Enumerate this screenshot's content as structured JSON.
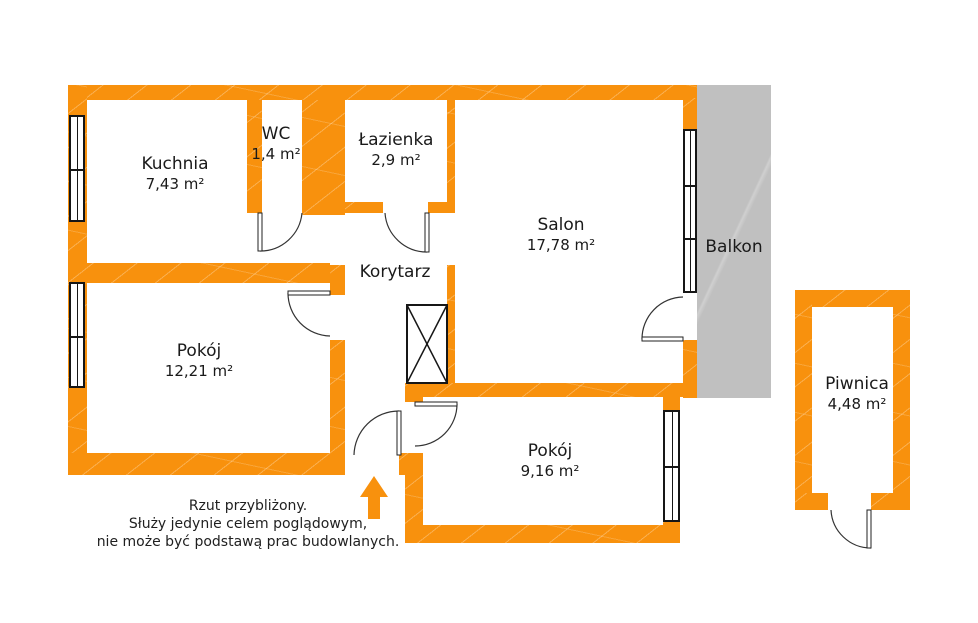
{
  "title": "Rzut mieszkania",
  "colors": {
    "wall": "#f8910d",
    "balcony": "#c0c0c0",
    "text": "#1a1a1a"
  },
  "rooms": [
    {
      "id": "kuchnia",
      "name": "Kuchnia",
      "area": "7,43 m²",
      "cx": 175,
      "cy": 174
    },
    {
      "id": "wc",
      "name": "WC",
      "area": "1,4 m²",
      "cx": 276,
      "cy": 144
    },
    {
      "id": "lazienka",
      "name": "Łazienka",
      "area": "2,9 m²",
      "cx": 396,
      "cy": 150
    },
    {
      "id": "salon",
      "name": "Salon",
      "area": "17,78 m²",
      "cx": 561,
      "cy": 235
    },
    {
      "id": "pokoj-1",
      "name": "Pokój",
      "area": "12,21 m²",
      "cx": 199,
      "cy": 361
    },
    {
      "id": "pokoj-2",
      "name": "Pokój",
      "area": "9,16 m²",
      "cx": 550,
      "cy": 461
    },
    {
      "id": "piwnica",
      "name": "Piwnica",
      "area": "4,48 m²",
      "cx": 857,
      "cy": 394
    }
  ],
  "korytarz_label": {
    "text": "Korytarz"
  },
  "balkon": {
    "label": "Balkon"
  },
  "disclaimer": {
    "lines": [
      "Rzut przybliżony.",
      "Służy jedynie celem poglądowym,",
      "nie może być podstawą prac budowlanych."
    ]
  },
  "geometry": {
    "walls": [
      {
        "name": "outer-top",
        "rect": [
          68,
          85,
          629,
          15
        ]
      },
      {
        "name": "outer-left",
        "rect": [
          68,
          85,
          19,
          390
        ]
      },
      {
        "name": "kitchen-wc-wall",
        "rect": [
          247,
          100,
          15,
          113
        ]
      },
      {
        "name": "wc-bath-block",
        "rect": [
          302,
          100,
          43,
          115
        ]
      },
      {
        "name": "bath-bottom-left",
        "rect": [
          345,
          202,
          38,
          11
        ]
      },
      {
        "name": "bath-bottom-right",
        "rect": [
          428,
          202,
          27,
          11
        ]
      },
      {
        "name": "salon-left-upper",
        "rect": [
          447,
          100,
          8,
          110
        ]
      },
      {
        "name": "salon-left-lower",
        "rect": [
          447,
          265,
          8,
          132
        ]
      },
      {
        "name": "salon-bottom",
        "rect": [
          405,
          383,
          292,
          14
        ]
      },
      {
        "name": "salon-right-upper",
        "rect": [
          683,
          98,
          14,
          32
        ]
      },
      {
        "name": "salon-right-lower",
        "rect": [
          683,
          340,
          14,
          58
        ]
      },
      {
        "name": "kitchen-bottom",
        "rect": [
          68,
          263,
          262,
          20
        ]
      },
      {
        "name": "pokoj1-right-stub",
        "rect": [
          330,
          265,
          15,
          30
        ]
      },
      {
        "name": "pokoj1-right",
        "rect": [
          330,
          340,
          15,
          135
        ]
      },
      {
        "name": "outer-bottom-left",
        "rect": [
          68,
          453,
          277,
          22
        ]
      },
      {
        "name": "entrance-jamb",
        "rect": [
          399,
          453,
          24,
          22
        ]
      },
      {
        "name": "pokoj2-door-stub",
        "rect": [
          405,
          397,
          18,
          5
        ]
      },
      {
        "name": "pokoj2-left",
        "rect": [
          405,
          475,
          18,
          68
        ]
      },
      {
        "name": "pokoj2-bottom",
        "rect": [
          405,
          525,
          275,
          18
        ]
      },
      {
        "name": "pokoj2-right-upper",
        "rect": [
          663,
          397,
          17,
          13
        ]
      },
      {
        "name": "pokoj2-right-lower",
        "rect": [
          663,
          522,
          17,
          21
        ]
      },
      {
        "name": "piwnica-top",
        "rect": [
          795,
          290,
          115,
          17
        ]
      },
      {
        "name": "piwnica-left",
        "rect": [
          795,
          290,
          17,
          220
        ]
      },
      {
        "name": "piwnica-right",
        "rect": [
          893,
          290,
          17,
          220
        ]
      },
      {
        "name": "piwnica-bottom-left",
        "rect": [
          795,
          493,
          33,
          17
        ]
      },
      {
        "name": "piwnica-bottom-right",
        "rect": [
          871,
          493,
          39,
          17
        ]
      }
    ],
    "windows": [
      {
        "name": "kitchen-window",
        "rect": [
          69,
          115,
          16,
          107
        ],
        "dividers": [
          169
        ]
      },
      {
        "name": "pokoj1-window",
        "rect": [
          69,
          282,
          16,
          106
        ],
        "dividers": [
          336
        ]
      },
      {
        "name": "salon-window",
        "rect": [
          683,
          129,
          14,
          164
        ],
        "dividers": [
          185,
          238
        ]
      },
      {
        "name": "pokoj2-window",
        "rect": [
          663,
          410,
          17,
          112
        ],
        "dividers": [
          466
        ]
      }
    ],
    "doors": [
      {
        "name": "wc-door",
        "leaf": [
          258,
          213,
          4,
          38
        ],
        "arc": "M 302 213 A 42 42 0 0 1 260 251"
      },
      {
        "name": "bathroom-door",
        "leaf": [
          425,
          213,
          4,
          39
        ],
        "arc": "M 385 213 A 42 42 0 0 0 427 252"
      },
      {
        "name": "pokoj1-door",
        "leaf": [
          288,
          291,
          42,
          4
        ],
        "arc": "M 288 293 A 43 43 0 0 0 330 336"
      },
      {
        "name": "entrance-door",
        "leaf": [
          397,
          411,
          4,
          44
        ],
        "arc": "M 399 411 A 45 45 0 0 0 354 455"
      },
      {
        "name": "pokoj2-door",
        "leaf": [
          415,
          402,
          42,
          4
        ],
        "arc": "M 457 404 A 42 42 0 0 1 415 446"
      },
      {
        "name": "balcony-door",
        "leaf": [
          642,
          337,
          41,
          4
        ],
        "arc": "M 642 339 A 42 42 0 0 1 683 297"
      },
      {
        "name": "piwnica-door",
        "leaf": [
          867,
          510,
          4,
          38
        ],
        "arc": "M 831 510 A 40 40 0 0 0 871 548"
      }
    ],
    "shaft": {
      "name": "elevator-shaft",
      "rect": [
        407,
        305,
        40,
        78
      ]
    },
    "entrance_arrow": {
      "points": "374,476 388,497 380,497 380,519 368,519 368,497 360,497"
    }
  }
}
